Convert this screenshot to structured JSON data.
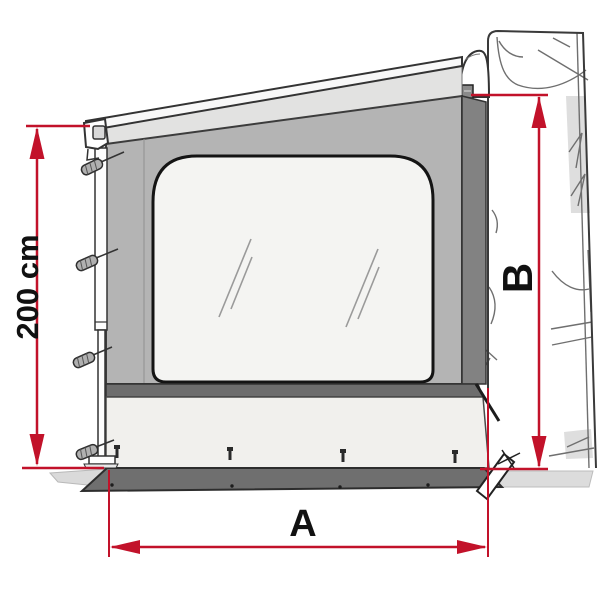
{
  "labels": {
    "panel_height": "200 cm",
    "awning_width": "A",
    "mount_height": "B"
  },
  "colors": {
    "dimension_red": "#c2122a",
    "panel_gray": "#b4b4b4",
    "dark_band_gray": "#6d6d6d",
    "edge_strip_gray": "#828282",
    "apron_white": "#f1f0ed",
    "window_white": "#f4f4f2",
    "ground_gray": "#dcdcdc",
    "outline": "#333333"
  }
}
